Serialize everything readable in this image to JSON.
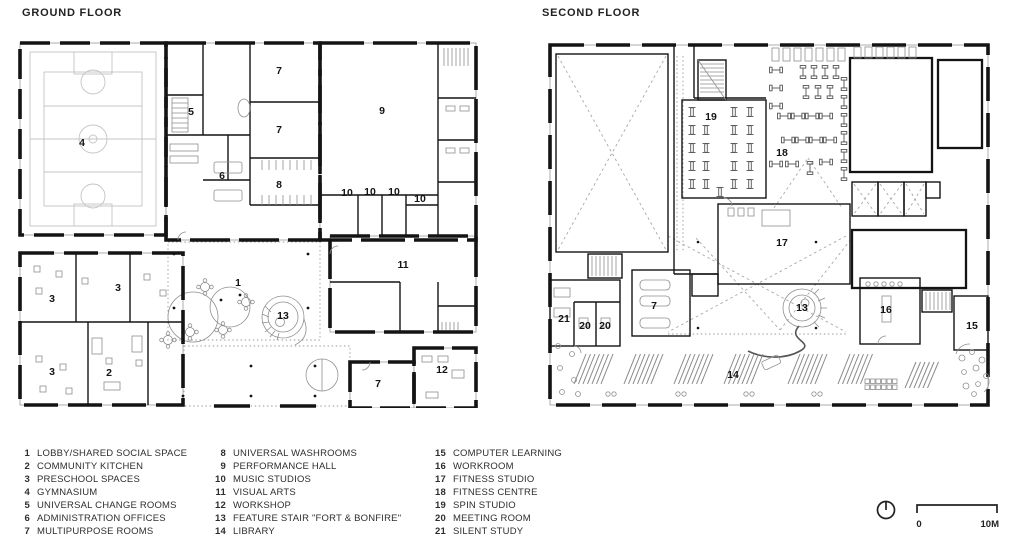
{
  "ground_floor": {
    "title": "GROUND FLOOR",
    "room_labels": [
      {
        "n": "4",
        "x": 64,
        "y": 103
      },
      {
        "n": "5",
        "x": 173,
        "y": 72
      },
      {
        "n": "6",
        "x": 204,
        "y": 136
      },
      {
        "n": "7",
        "x": 261,
        "y": 31
      },
      {
        "n": "7",
        "x": 261,
        "y": 90
      },
      {
        "n": "8",
        "x": 261,
        "y": 145
      },
      {
        "n": "9",
        "x": 364,
        "y": 71
      },
      {
        "n": "10",
        "x": 329,
        "y": 153
      },
      {
        "n": "10",
        "x": 352,
        "y": 152
      },
      {
        "n": "10",
        "x": 376,
        "y": 152
      },
      {
        "n": "10",
        "x": 402,
        "y": 159
      },
      {
        "n": "11",
        "x": 385,
        "y": 225
      },
      {
        "n": "1",
        "x": 220,
        "y": 243
      },
      {
        "n": "13",
        "x": 265,
        "y": 276
      },
      {
        "n": "3",
        "x": 34,
        "y": 259
      },
      {
        "n": "3",
        "x": 100,
        "y": 248
      },
      {
        "n": "3",
        "x": 34,
        "y": 332
      },
      {
        "n": "2",
        "x": 91,
        "y": 333
      },
      {
        "n": "7",
        "x": 360,
        "y": 344
      },
      {
        "n": "12",
        "x": 424,
        "y": 330
      }
    ]
  },
  "second_floor": {
    "title": "SECOND FLOOR",
    "room_labels": [
      {
        "n": "19",
        "x": 163,
        "y": 75
      },
      {
        "n": "18",
        "x": 234,
        "y": 111
      },
      {
        "n": "17",
        "x": 234,
        "y": 201
      },
      {
        "n": "7",
        "x": 106,
        "y": 264
      },
      {
        "n": "21",
        "x": 16,
        "y": 277
      },
      {
        "n": "20",
        "x": 37,
        "y": 284
      },
      {
        "n": "20",
        "x": 57,
        "y": 284
      },
      {
        "n": "13",
        "x": 254,
        "y": 266
      },
      {
        "n": "16",
        "x": 338,
        "y": 268
      },
      {
        "n": "15",
        "x": 424,
        "y": 284
      },
      {
        "n": "14",
        "x": 185,
        "y": 333
      }
    ]
  },
  "legend": {
    "columns": [
      [
        {
          "num": "1",
          "label": "LOBBY/SHARED SOCIAL SPACE"
        },
        {
          "num": "2",
          "label": "COMMUNITY KITCHEN"
        },
        {
          "num": "3",
          "label": "PRESCHOOL SPACES"
        },
        {
          "num": "4",
          "label": "GYMNASIUM"
        },
        {
          "num": "5",
          "label": "UNIVERSAL CHANGE ROOMS"
        },
        {
          "num": "6",
          "label": "ADMINISTRATION OFFICES"
        },
        {
          "num": "7",
          "label": "MULTIPURPOSE ROOMS"
        }
      ],
      [
        {
          "num": "8",
          "label": "UNIVERSAL WASHROOMS"
        },
        {
          "num": "9",
          "label": "PERFORMANCE HALL"
        },
        {
          "num": "10",
          "label": "MUSIC STUDIOS"
        },
        {
          "num": "11",
          "label": "VISUAL ARTS"
        },
        {
          "num": "12",
          "label": "WORKSHOP"
        },
        {
          "num": "13",
          "label": "FEATURE STAIR \"FORT & BONFIRE\""
        },
        {
          "num": "14",
          "label": "LIBRARY"
        }
      ],
      [
        {
          "num": "15",
          "label": "COMPUTER LEARNING"
        },
        {
          "num": "16",
          "label": "WORKROOM"
        },
        {
          "num": "17",
          "label": "FITNESS STUDIO"
        },
        {
          "num": "18",
          "label": "FITNESS CENTRE"
        },
        {
          "num": "19",
          "label": "SPIN STUDIO"
        },
        {
          "num": "20",
          "label": "MEETING ROOM"
        },
        {
          "num": "21",
          "label": "SILENT STUDY"
        }
      ]
    ]
  },
  "scale_bar": {
    "start": "0",
    "end": "10M"
  },
  "colors": {
    "ink": "#141414",
    "detail_gray": "#8f8f8f",
    "background": "#ffffff"
  }
}
